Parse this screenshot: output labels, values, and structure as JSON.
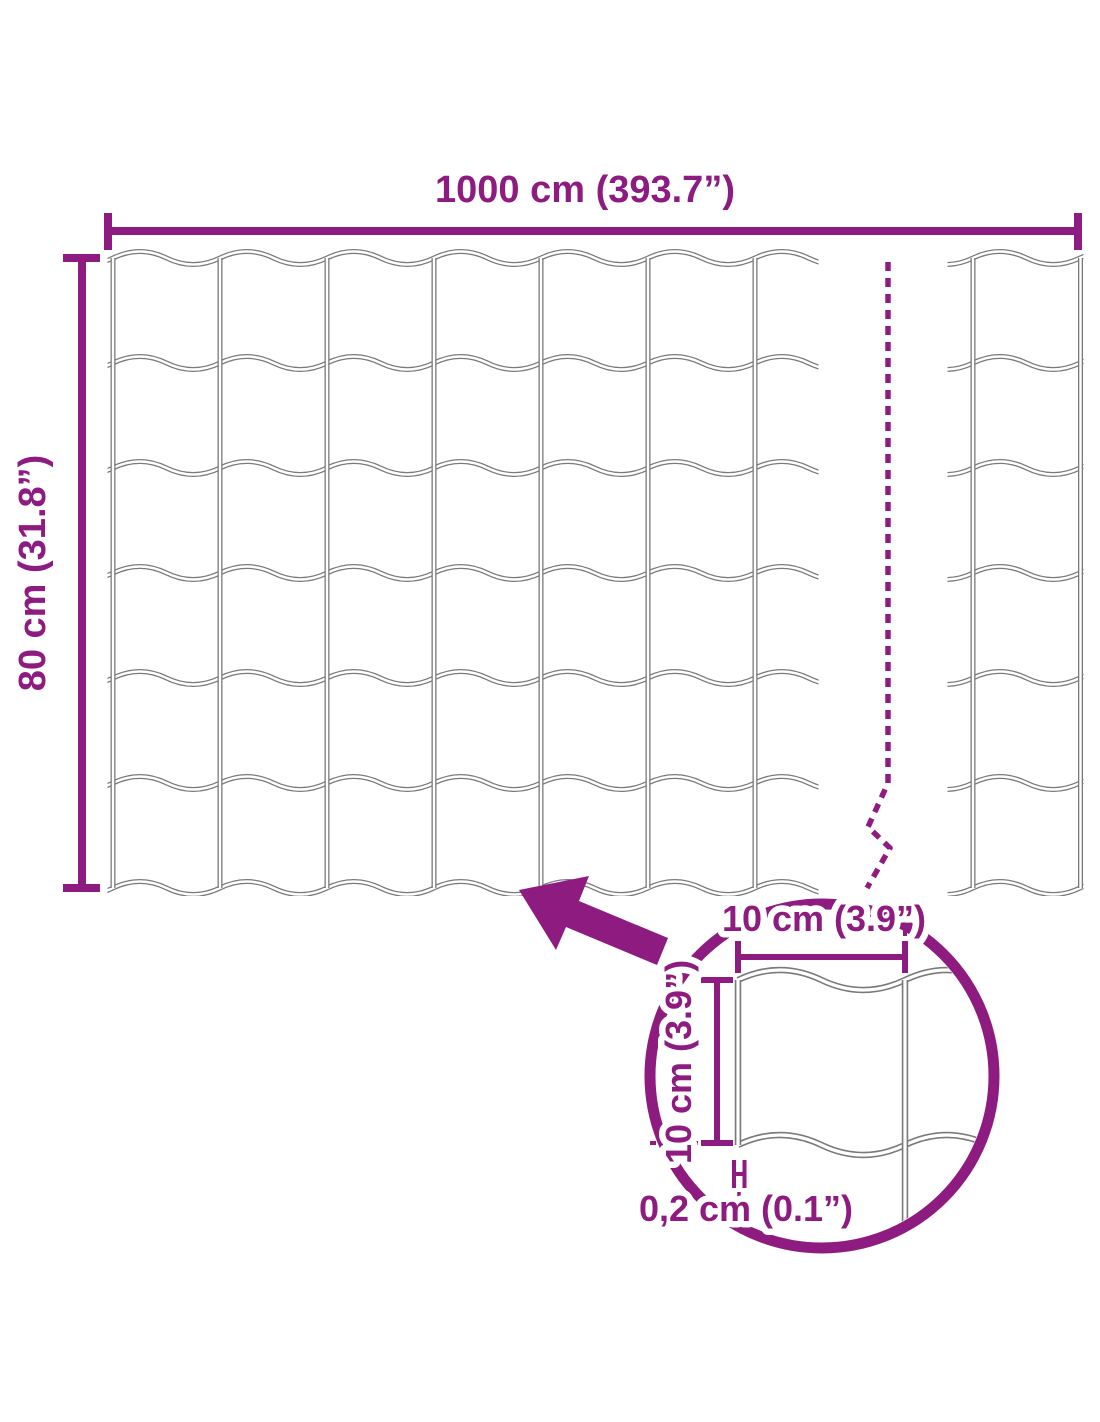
{
  "labels": {
    "total_width": "1000 cm (393.7”)",
    "total_height": "80 cm (31.8”)",
    "mesh_cell_width": "10 cm (3.9”)",
    "mesh_cell_height": "10 cm (3.9”)",
    "wire_thickness": "0,2 cm (0.1”)"
  },
  "colors": {
    "accent": "#8e1c80",
    "wire_gray": "#7a7a7a",
    "background": "#ffffff"
  }
}
